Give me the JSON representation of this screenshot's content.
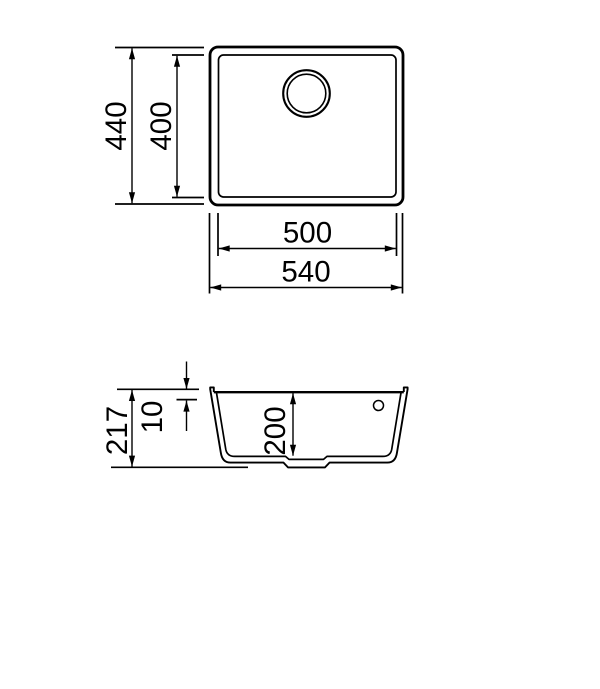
{
  "drawing": {
    "type": "technical-dimension-drawing",
    "subject": "undermount-sink",
    "line_color": "#000000",
    "background_color": "#ffffff",
    "top_view": {
      "outer_height": "440",
      "inner_height": "400",
      "inner_width": "500",
      "outer_width": "540"
    },
    "section_view": {
      "total_height": "217",
      "rim_height": "10",
      "bowl_depth": "200"
    }
  }
}
